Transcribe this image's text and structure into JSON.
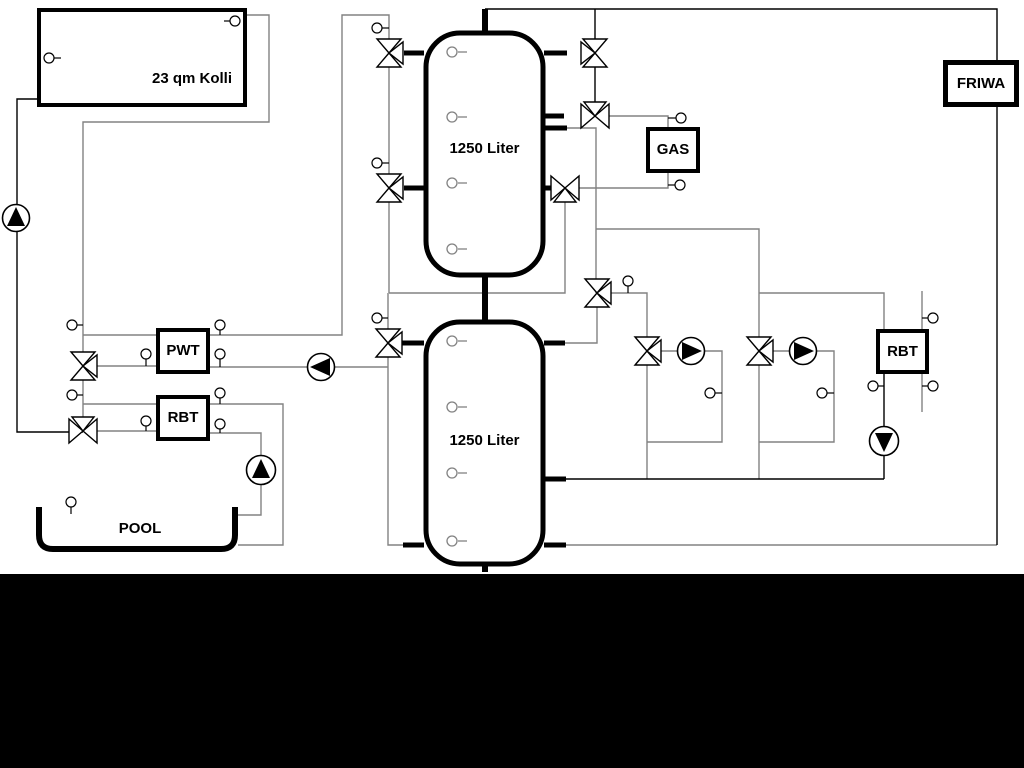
{
  "diagram": {
    "type": "hydraulic-schematic",
    "labels": {
      "collector": "23 qm Kolli",
      "tank_upper": "1250 Liter",
      "tank_lower": "1250 Liter",
      "gas": "GAS",
      "friwa": "FRIWA",
      "pwt": "PWT",
      "rbt_left": "RBT",
      "rbt_right": "RBT",
      "pool": "POOL"
    },
    "colors": {
      "background": "#ffffff",
      "pipe_gray": "#828282",
      "pipe_black": "#000000",
      "outline": "#000000",
      "symbol_fill": "#ffffff",
      "bottom_bar": "#000000"
    },
    "icons": {
      "pump": "circle-with-filled-triangle",
      "three_way_valve": "bowtie-with-branch-triangle",
      "sensor": "small-circle-with-stem"
    },
    "counts": {
      "storage_tanks": 2,
      "pumps": 6,
      "three_way_valves": 11,
      "sensors": 30
    }
  }
}
